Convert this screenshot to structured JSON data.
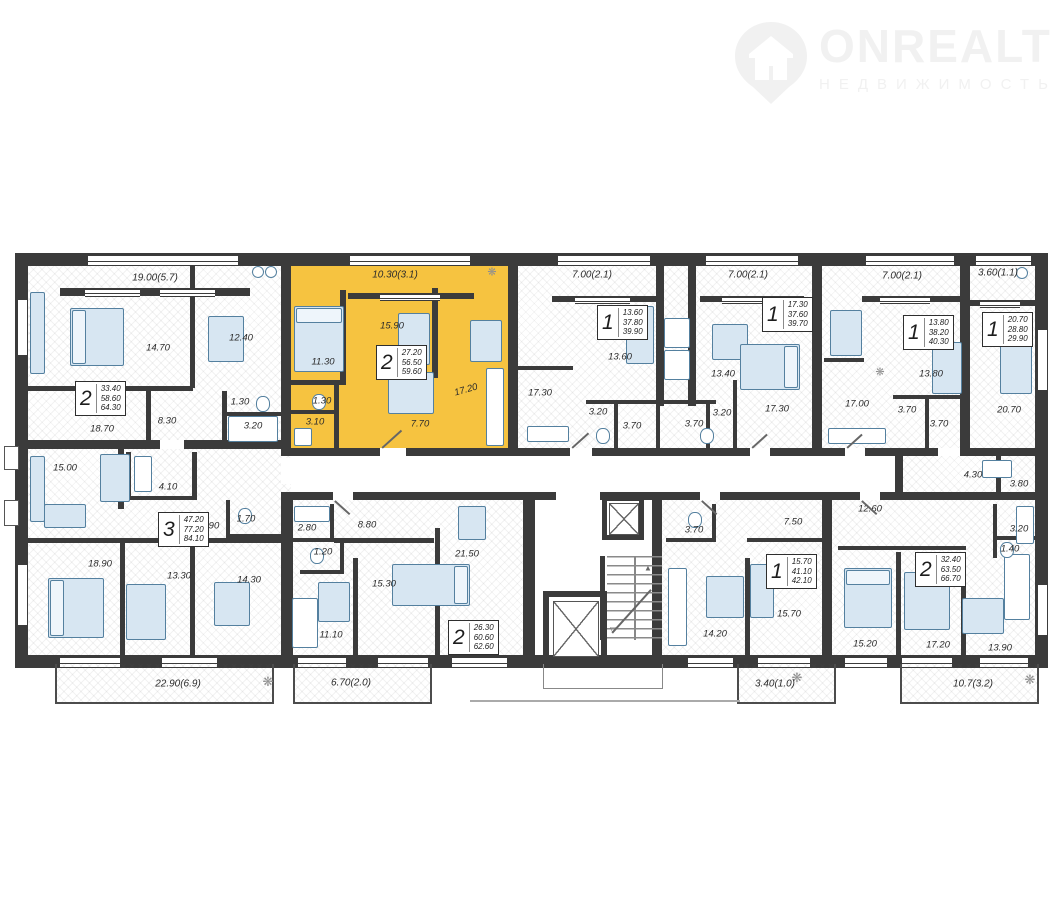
{
  "brand": {
    "name": "ONREALT",
    "subtitle": "НЕДВИЖИМОСТЬ"
  },
  "colors": {
    "highlight": "#F6C340",
    "wall": "#3b3b3b",
    "furniture_fill": "#d7e6f2",
    "furniture_line": "#54809f"
  },
  "apartments": [
    {
      "key": "a",
      "num": "2",
      "areas": [
        "33.40",
        "58.60",
        "64.30"
      ],
      "rooms": [
        "14.70",
        "12.40",
        "18.70",
        "8.30",
        "1.30",
        "3.20"
      ],
      "balcony": "19.00(5.7)"
    },
    {
      "key": "b",
      "num": "2",
      "areas": [
        "27.20",
        "56.50",
        "59.60"
      ],
      "rooms": [
        "15.90",
        "11.30",
        "17.20",
        "1.30",
        "3.10",
        "7.70"
      ],
      "balcony": "10.30(3.1)",
      "highlighted": true
    },
    {
      "key": "c",
      "num": "1",
      "areas": [
        "13.60",
        "37.80",
        "39.90"
      ],
      "rooms": [
        "13.60",
        "17.30",
        "3.20",
        "3.70"
      ],
      "balcony": "7.00(2.1)"
    },
    {
      "key": "d",
      "num": "1",
      "areas": [
        "17.30",
        "37.60",
        "39.70"
      ],
      "rooms": [
        "13.40",
        "17.30",
        "3.20",
        "3.70"
      ],
      "balcony": "7.00(2.1)"
    },
    {
      "key": "e",
      "num": "1",
      "areas": [
        "13.80",
        "38.20",
        "40.30"
      ],
      "rooms": [
        "13.80",
        "17.00",
        "3.70",
        "3.70"
      ],
      "balcony": "7.00(2.1)"
    },
    {
      "key": "f",
      "num": "1",
      "areas": [
        "20.70",
        "28.80",
        "29.90"
      ],
      "rooms": [
        "20.70",
        "4.30",
        "3.80"
      ],
      "balcony": "3.60(1.1)"
    },
    {
      "key": "g",
      "num": "3",
      "areas": [
        "47.20",
        "77.20",
        "84.10"
      ],
      "rooms": [
        "15.00",
        "4.10",
        "9.90",
        "1.70",
        "18.90",
        "13.30",
        "14.30"
      ],
      "balcony": "22.90(6.9)"
    },
    {
      "key": "h",
      "num": "2",
      "areas": [
        "26.30",
        "60.60",
        "62.60"
      ],
      "rooms": [
        "2.80",
        "8.80",
        "1.20",
        "11.10",
        "15.30",
        "21.50"
      ],
      "balcony": "6.70(2.0)"
    },
    {
      "key": "i",
      "num": "1",
      "areas": [
        "15.70",
        "41.10",
        "42.10"
      ],
      "rooms": [
        "3.70",
        "7.50",
        "14.20",
        "15.70"
      ],
      "balcony": "3.40(1.0)"
    },
    {
      "key": "j",
      "num": "2",
      "areas": [
        "32.40",
        "63.50",
        "66.70"
      ],
      "rooms": [
        "12.60",
        "3.20",
        "1.40",
        "15.20",
        "17.20",
        "13.90"
      ],
      "balcony": "10.7(3.2)"
    }
  ]
}
